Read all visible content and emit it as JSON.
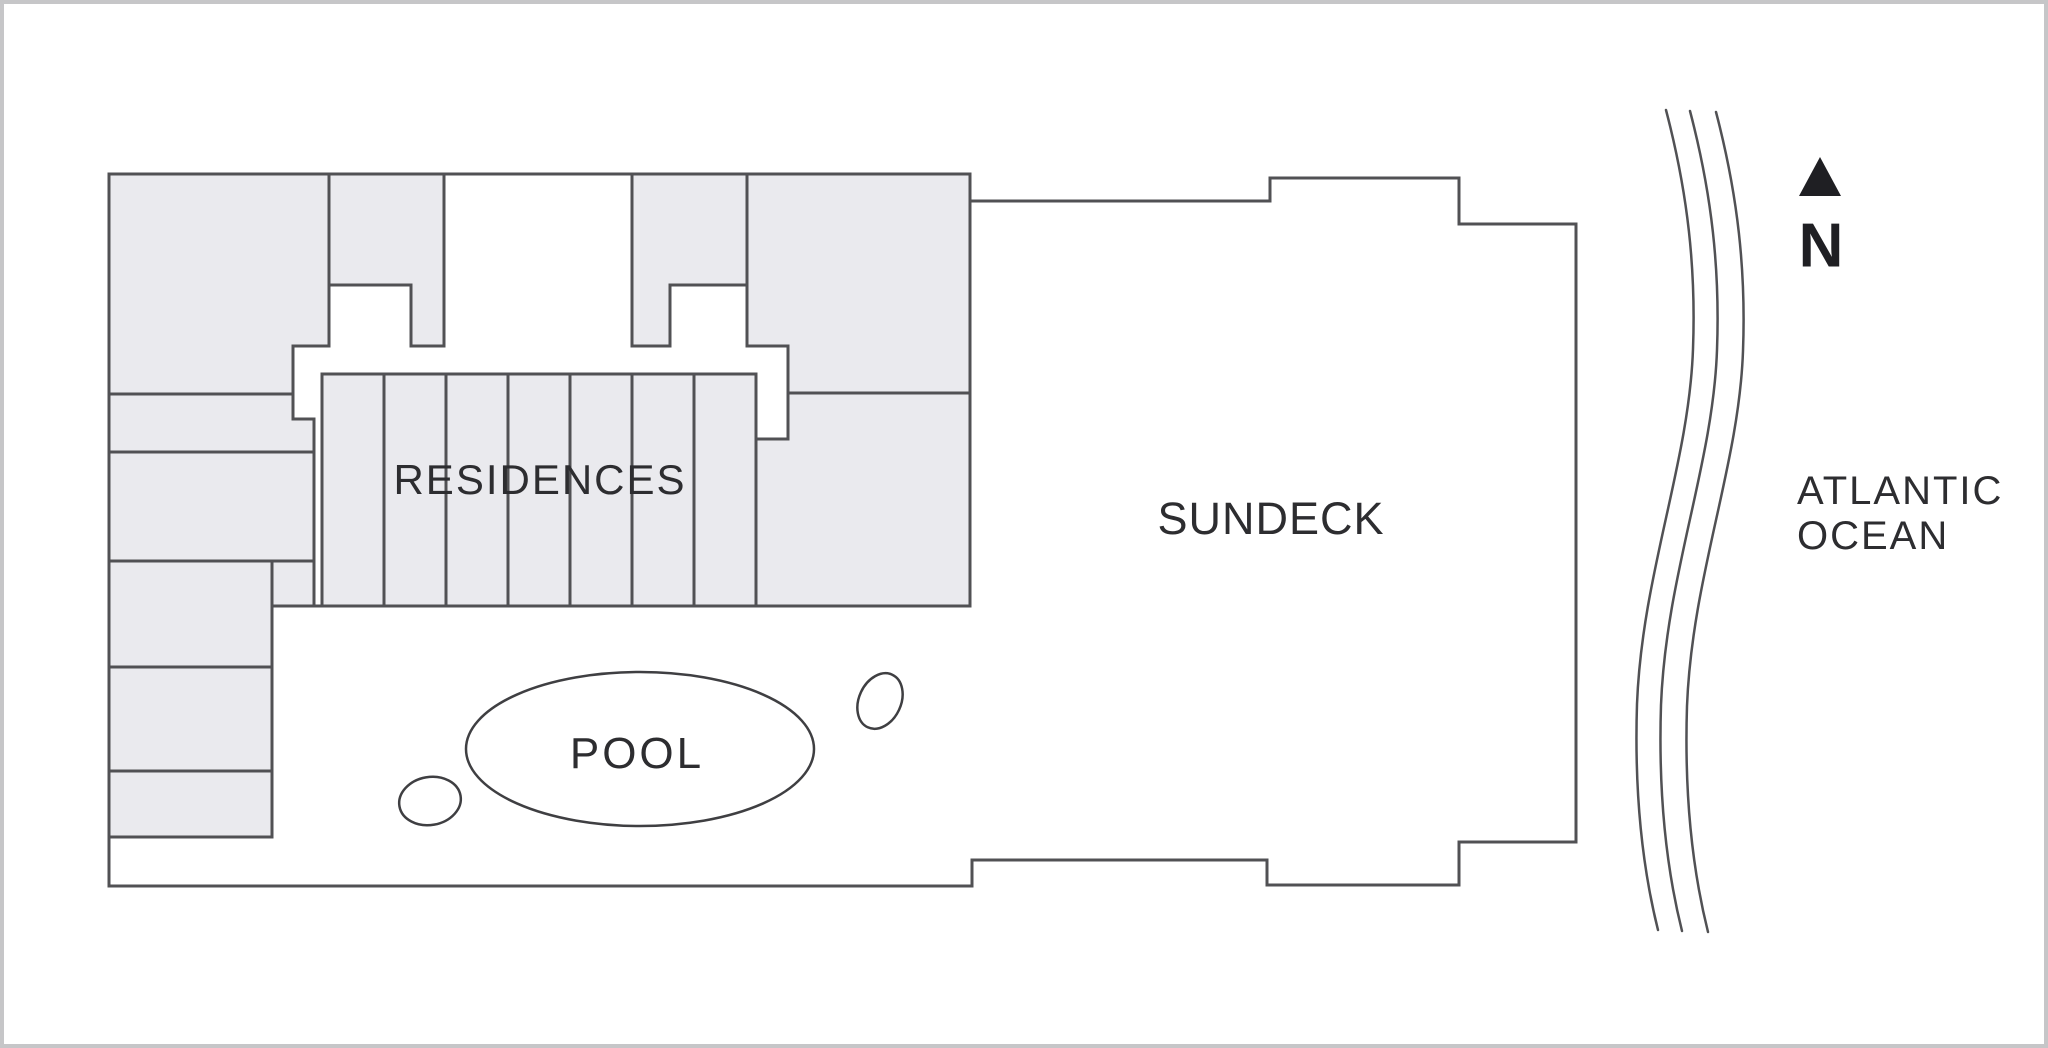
{
  "document": {
    "type": "architectural-site-plan",
    "orientation_marker": "north-arrow-icon"
  },
  "labels": {
    "residences": "RESIDENCES",
    "sundeck": "SUNDECK",
    "pool": "POOL",
    "ocean_line1": "ATLANTIC",
    "ocean_line2": "OCEAN",
    "north": "N"
  },
  "colors": {
    "wall_line": "#515154",
    "room_fill": "#eaeaee",
    "page_background": "#ffffff",
    "frame_border": "#c6c6c8",
    "text": "#2d2d30",
    "north_marker": "#1f1f23"
  }
}
